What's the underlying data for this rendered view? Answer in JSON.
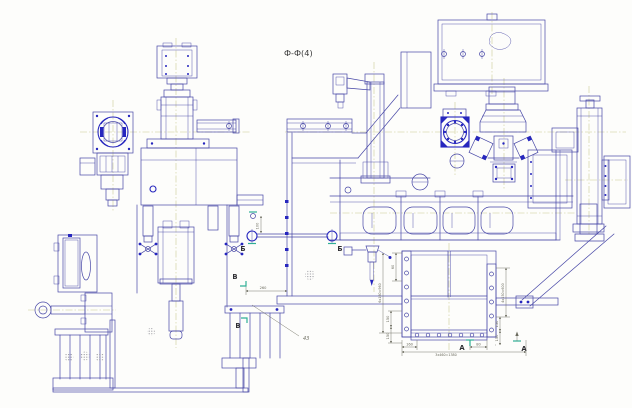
{
  "drawing": {
    "title": "Ф-Ф(4)",
    "callout_number": "43",
    "sections": {
      "a_left": "А",
      "a_right": "А",
      "b_left": "Б",
      "b_right": "Б",
      "v_upper": "В",
      "v_lower": "В"
    },
    "dims": {
      "v100": "100",
      "h260": "260",
      "v60": "60",
      "v6x160": "6x160=960",
      "v150_lt": "150",
      "v150_lb": "150",
      "h160": "160",
      "h3x460": "3x460=1380",
      "h80": "80",
      "v4x150": "4x150=600",
      "v150_rt": "150",
      "v150_rb": "150"
    },
    "colors": {
      "line": "#4646a6",
      "accent": "#2626be",
      "centerline": "#c9c98e",
      "section_mark": "#2fae96",
      "dim_text": "#6b6b5e",
      "title_text": "#3a3a3a",
      "background": "#fdfdfb"
    }
  }
}
